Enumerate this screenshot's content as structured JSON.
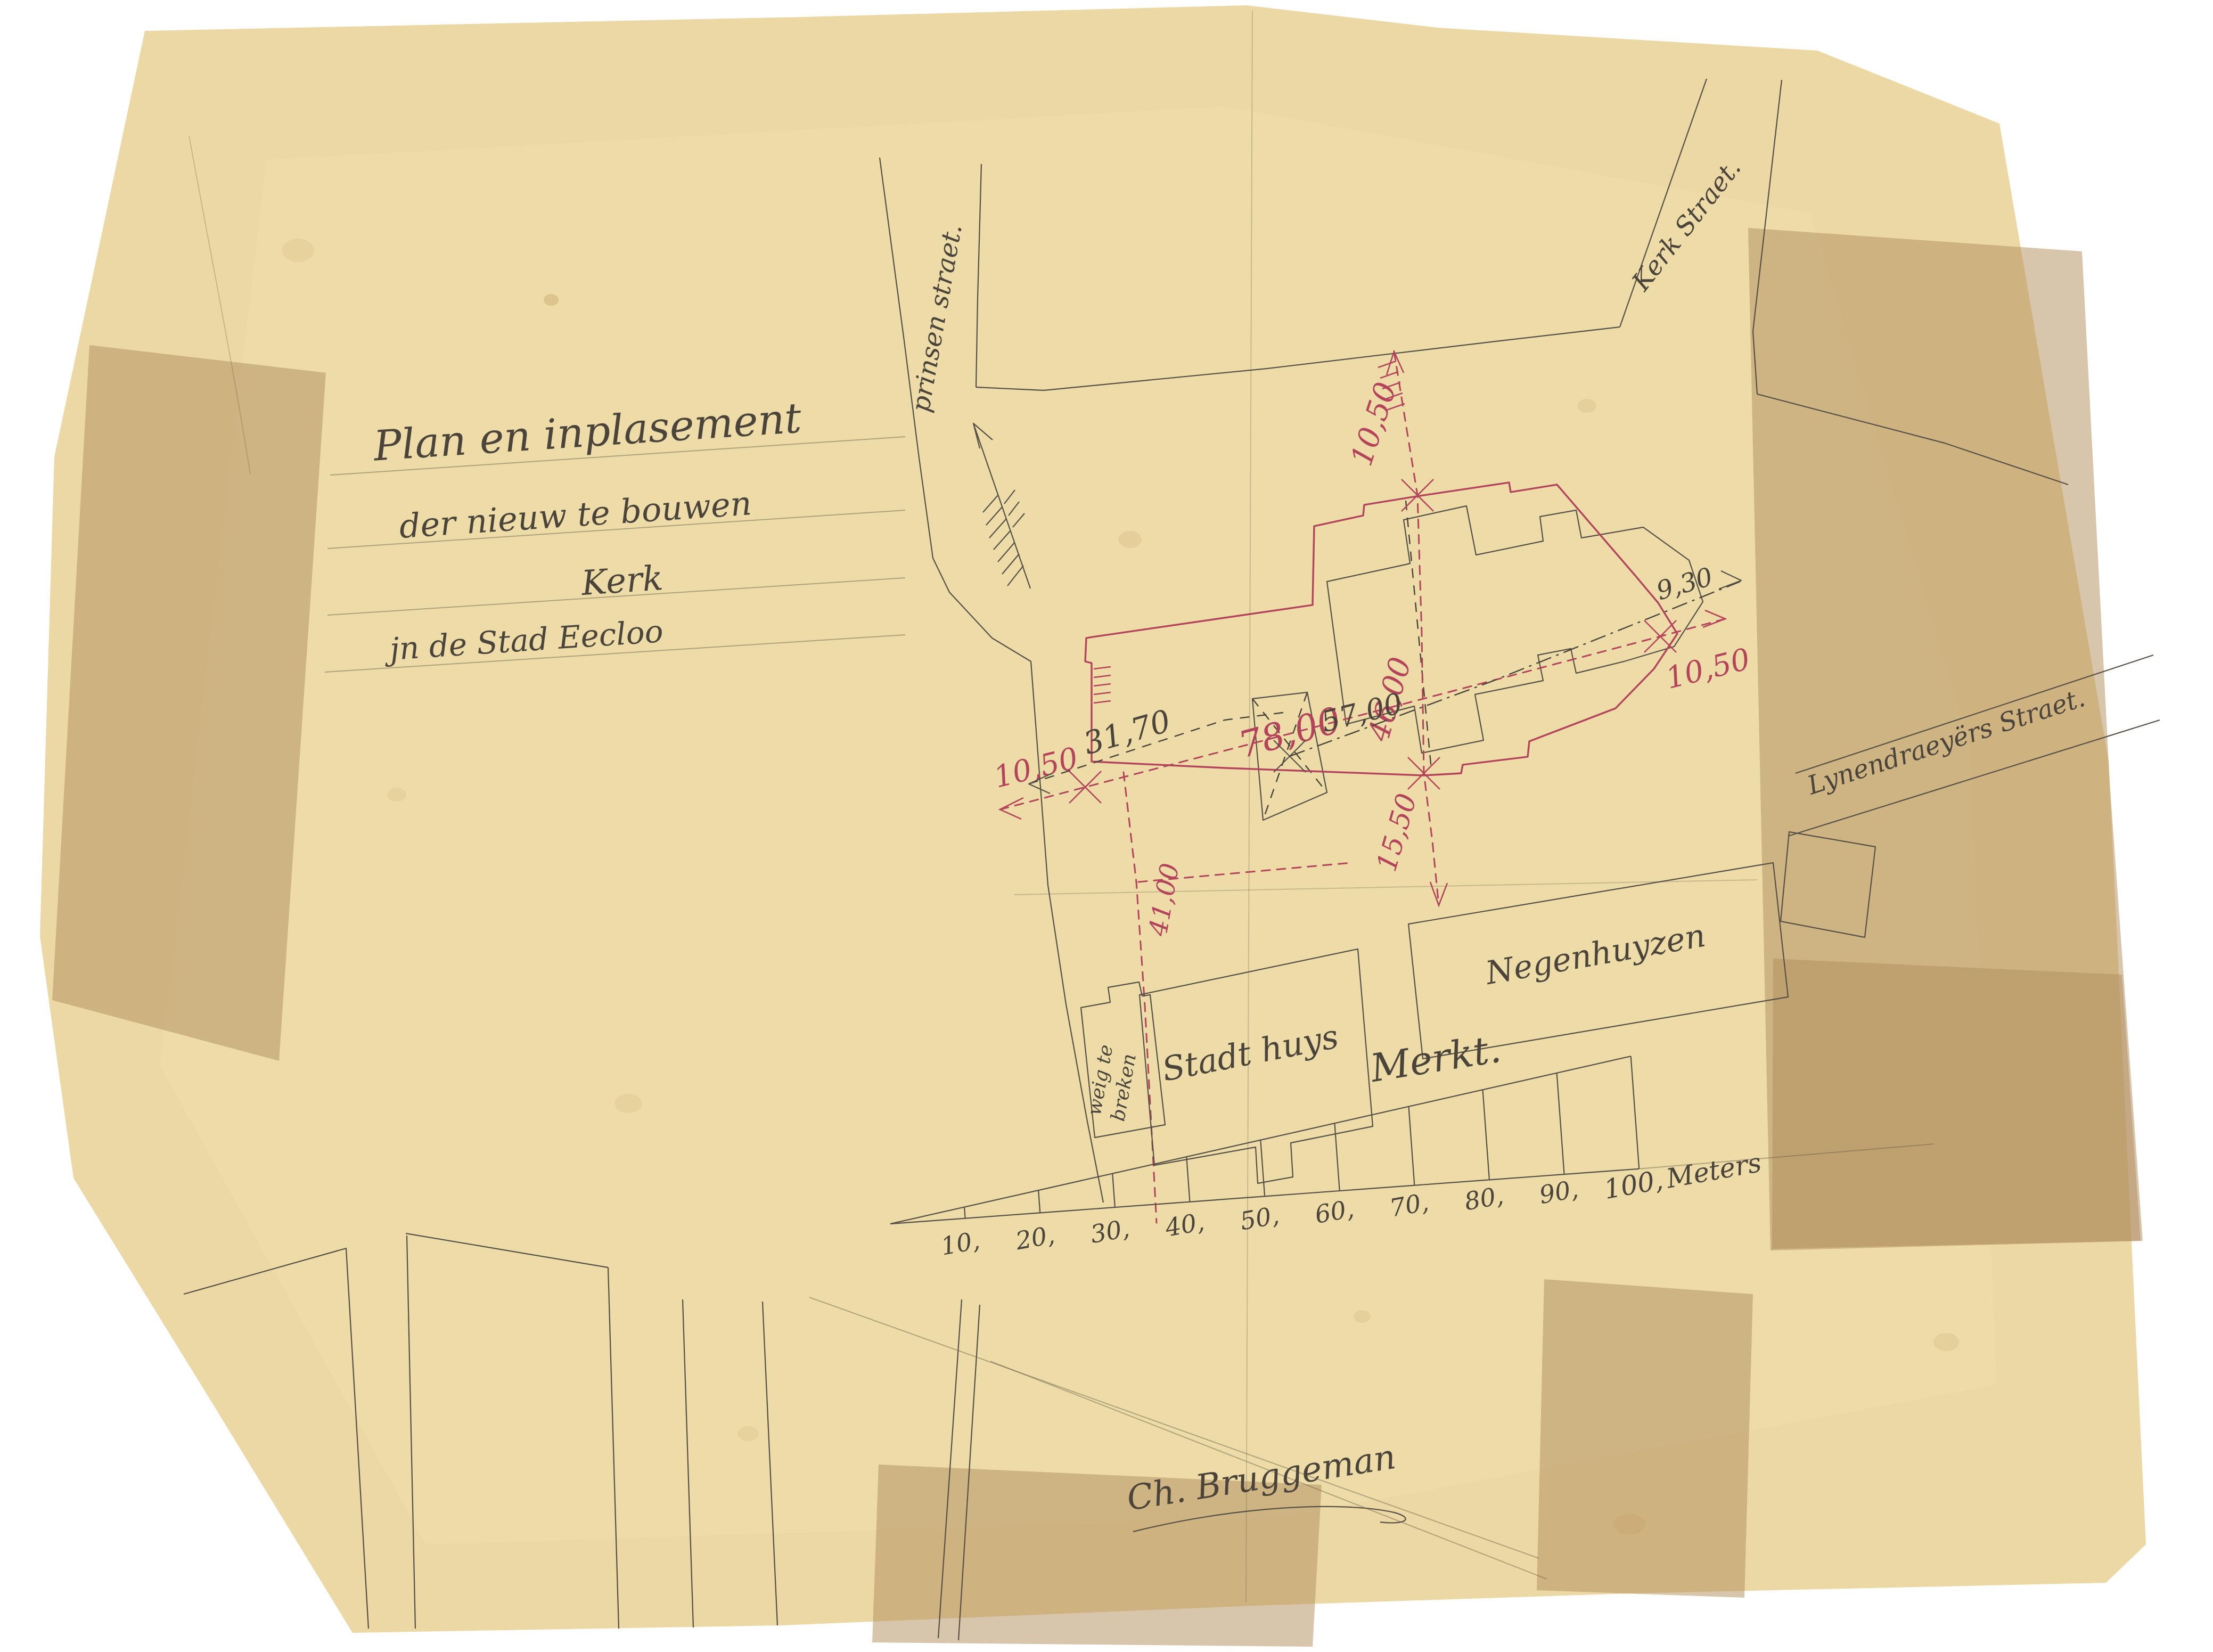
{
  "document": {
    "kind": "scanned hand-drawn site plan",
    "title": {
      "line1": "Plan en inplasement",
      "line2": "der  nieuw  te bouwen",
      "line3": "Kerk",
      "line4": "jn de Stad  Eecloo"
    },
    "streets": {
      "prinsen": "prinsen straet.",
      "kerk": "Kerk Straet.",
      "lynendraeyers": "Lynendraeyërs  Straet."
    },
    "buildings": {
      "stadhuys": "Stadt huys",
      "negenhuyzen": "Negenhuyzen",
      "weg_te_breken_line1": "weig te",
      "weg_te_breken_line2": "breken",
      "markt": "Merkt."
    },
    "dimensions_red": {
      "top_vertical": "10,50",
      "left": "10,50",
      "main_axis": "78,00",
      "cross_vertical": "46,00",
      "below_church": "15,50",
      "right": "10,50",
      "stadhuys_vertical": "41,00"
    },
    "dimensions_black": {
      "church_axis": "57,00",
      "west_offset": "31,70",
      "east_offset": "9,30"
    },
    "scale_bar": {
      "ticks": [
        "10,",
        "20,",
        "30,",
        "40,",
        "50,",
        "60,",
        "70,",
        "80,",
        "90,",
        "100,"
      ],
      "unit": "Meters"
    },
    "signature": "Ch. Bruggeman",
    "colors": {
      "paper": "#ecd8a4",
      "ink": "#49433a",
      "red_ink": "#b4445c",
      "tape": "#b3905f",
      "background": "#ffffff"
    }
  }
}
